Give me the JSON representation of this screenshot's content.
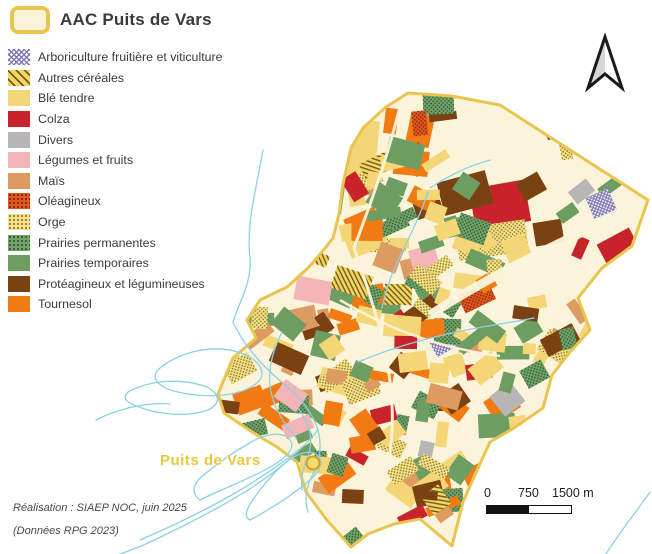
{
  "title": {
    "label": "AAC Puits de Vars",
    "symbol": "aac-boundary-swatch",
    "symbol_fill": "#FBF4DB",
    "symbol_stroke": "#E9C44F"
  },
  "legend": {
    "items": [
      {
        "label": "Arboriculture fruitière et viticulture",
        "style": "crosshatch",
        "bg": "#FFFFFF",
        "fg": "#8377B5"
      },
      {
        "label": "Autres céréales",
        "style": "hatch",
        "bg": "#F5D463",
        "fg": "#6E5D1B"
      },
      {
        "label": "Blé tendre",
        "style": "solid",
        "bg": "#F5D676",
        "fg": "#F5D676"
      },
      {
        "label": "Colza",
        "style": "solid",
        "bg": "#C8232B",
        "fg": "#C8232B"
      },
      {
        "label": "Divers",
        "style": "solid",
        "bg": "#B7B6B5",
        "fg": "#B7B6B5"
      },
      {
        "label": "Légumes et fruits",
        "style": "solid",
        "bg": "#F3B5B8",
        "fg": "#F3B5B8"
      },
      {
        "label": "Maïs",
        "style": "solid",
        "bg": "#DE9B61",
        "fg": "#DE9B61"
      },
      {
        "label": "Oléagineux",
        "style": "dots",
        "bg": "#E2571C",
        "fg": "#7E2A0B"
      },
      {
        "label": "Orge",
        "style": "dots",
        "bg": "#F6E18A",
        "fg": "#8B7D26"
      },
      {
        "label": "Prairies permanentes",
        "style": "dots",
        "bg": "#74A36A",
        "fg": "#2E5D33"
      },
      {
        "label": "Prairies temporaires",
        "style": "solid",
        "bg": "#6E9D62",
        "fg": "#6E9D62"
      },
      {
        "label": "Protéagineux et légumineuses",
        "style": "solid",
        "bg": "#7A4212",
        "fg": "#7A4212"
      },
      {
        "label": "Tournesol",
        "style": "solid",
        "bg": "#F27A13",
        "fg": "#F27A13"
      }
    ]
  },
  "map": {
    "place_label": "Puits de Vars",
    "place_label_color": "#E8C73F",
    "boundary_fill": "#FBF4DB",
    "boundary_stroke": "#E9C44F",
    "stream_color": "#8CD0E6",
    "marker_fill": "#F4DC6C",
    "marker_stroke": "#C9A227"
  },
  "scale_bar": {
    "ticks": [
      "0",
      "750",
      "1500 m"
    ]
  },
  "north_arrow": "north-arrow",
  "credits": {
    "line1": "Réalisation : SIAEP NOC, juin 2025",
    "line2": "(Données RPG 2023)"
  }
}
